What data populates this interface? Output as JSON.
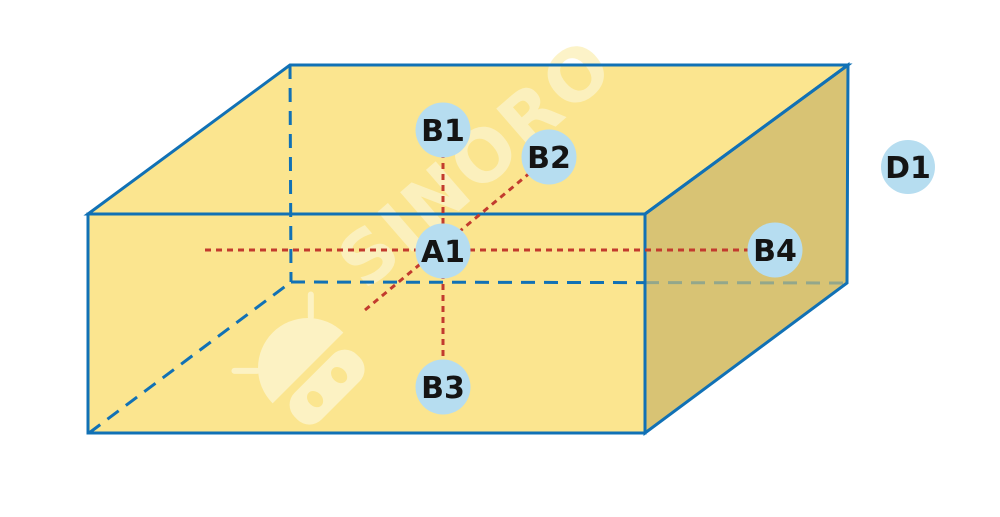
{
  "diagram": {
    "watermark": {
      "text": "SINORO",
      "logo": "robot-head-icon"
    },
    "points": [
      {
        "label": "A1"
      },
      {
        "label": "B1"
      },
      {
        "label": "B2"
      },
      {
        "label": "B3"
      },
      {
        "label": "B4"
      },
      {
        "label": "D1"
      }
    ]
  },
  "colors": {
    "face_light": "#FBE58F",
    "face_shaded": "#D8C374",
    "edge_blue": "#1171B5",
    "hidden_edge_muted": "#93A78B",
    "guide_red": "#C23B2E",
    "point_fill": "#B6DDF0",
    "point_text": "#141414",
    "watermark": "#FCF2C3"
  }
}
